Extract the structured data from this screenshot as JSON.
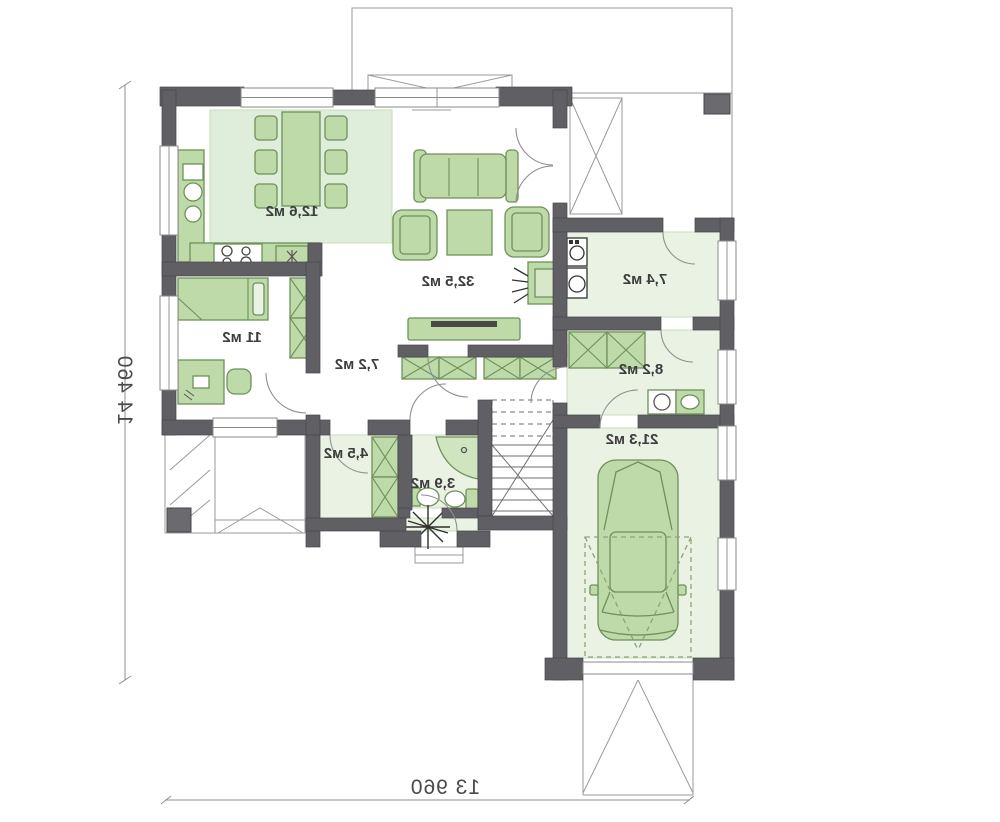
{
  "plan": {
    "type": "floor-plan",
    "units": "м2",
    "rooms": {
      "kitchen_dining": "12,6 м2",
      "living_room": "32,5 м2",
      "bedroom": "11 м2",
      "hall": "7,2 м2",
      "utility": "7,4 м2",
      "corridor": "8,2 м2",
      "wardrobe": "4,5 м2",
      "bathroom": "3,9 м2",
      "garage": "21,3 м2"
    },
    "dimensions": {
      "height": "14 460",
      "width": "13 960"
    }
  },
  "colors": {
    "wall": "#5f5f64",
    "room_fill": "#e9f2e3",
    "rug_fill": "#dfeeda",
    "furniture": "#bedaa8",
    "furniture_outline": "#6e915a",
    "line": "#8c8c8c",
    "text": "#3d3d3d"
  }
}
